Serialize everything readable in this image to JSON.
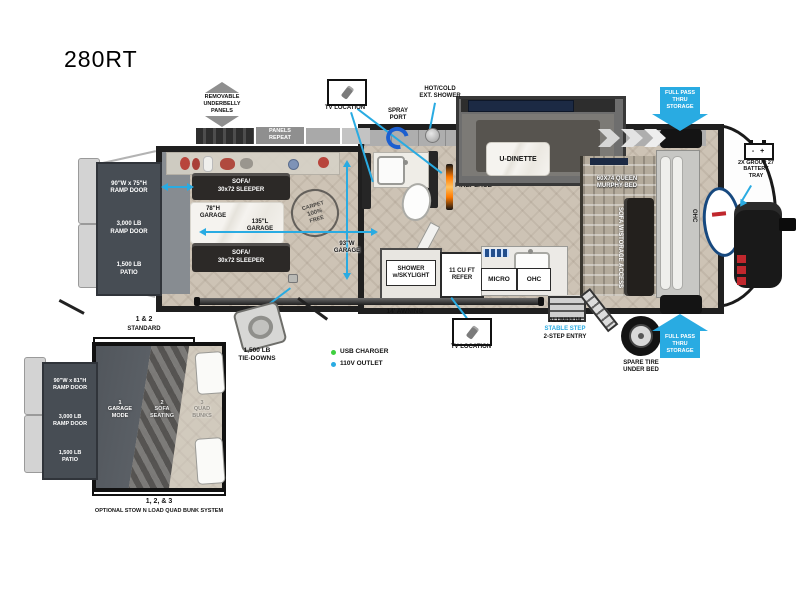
{
  "title": "280RT",
  "legend": {
    "usb": "USB CHARGER",
    "outlet": "110V OUTLET"
  },
  "annotations": {
    "underbelly": "REMOVABLE\nUNDERBELLY\nPANELS",
    "panels_repeat": "PANELS\nREPEAT",
    "tv_location": "TV LOCATION",
    "spray_port": "SPRAY\nPORT",
    "ext_shower": "HOT/COLD\nEXT. SHOWER",
    "full_pass": "FULL PASS\nTHRU\nSTORAGE",
    "battery_icon": "-  +",
    "battery_tray": "2X GROUP 27\nBATTERY\nTRAY",
    "awning": "14' AWNING",
    "entry_aluminum": "ALUMINUM",
    "entry_stable": "STABLE STEP",
    "entry_2step": "2-STEP ENTRY",
    "spare_tire": "SPARE TIRE\nUNDER BED",
    "tie_downs": "1,500 LB\nTIE-DOWNS"
  },
  "rear": {
    "door_size": "90\"W x 75\"H\nRAMP DOOR",
    "door_weight": "3,000 LB\nRAMP DOOR",
    "patio": "1,500 LB\nPATIO"
  },
  "garage": {
    "sofa_top": "SOFA/\n30x72 SLEEPER",
    "sofa_bottom": "SOFA/\n30x72 SLEEPER",
    "dim_height": "78\"H\nGARAGE",
    "dim_length": "135\"L\nGARAGE",
    "dim_width": "93\"W\nGARAGE",
    "badge": {
      "top": "CARPET",
      "mid": "100%",
      "bottom": "FREE"
    }
  },
  "living": {
    "u_dinette": "U-DINETTE",
    "fireplace": "FIREPLACE",
    "shower": "SHOWER\nw/SKYLIGHT",
    "refer": "11 CU FT\nREFER",
    "micro": "MICRO",
    "ohc": "OHC",
    "murphy": "60X74 QUEEN\nMURPHY BED",
    "sofa_storage": "SOFA W/STORAGE ACCESS",
    "front_ohc": "OHC"
  },
  "inset": {
    "header_num": "1 & 2",
    "header_label": "STANDARD",
    "door_size": "90\"W x 81\"H\nRAMP DOOR",
    "door_weight": "3,000 LB\nRAMP DOOR",
    "patio": "1,500 LB\nPATIO",
    "mode1": "1\nGARAGE\nMODE",
    "mode2": "2\nSOFA\nSEATING",
    "mode3": "3\nQUAD\nBUNKS",
    "footer_num": "1, 2, & 3",
    "footer_label": "OPTIONAL STOW N LOAD QUAD BUNK SYSTEM"
  }
}
